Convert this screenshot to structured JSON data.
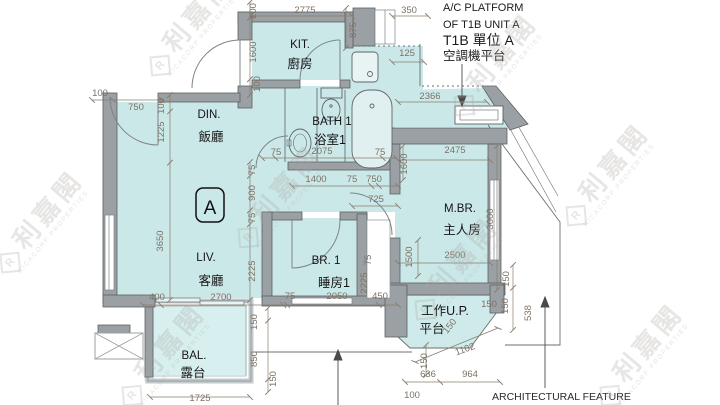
{
  "colors": {
    "room_fill": "#cbe8e9",
    "balcony_fill": "#d7efef",
    "wall": "#9aa0a3",
    "wall_edge": "#5c6164",
    "dim": "#7d7264",
    "label": "#141414",
    "watermark": "#a8a49f"
  },
  "unit_label": "A",
  "rooms": {
    "kitchen": {
      "en": "KIT.",
      "cn": "廚房"
    },
    "dining": {
      "en": "DIN.",
      "cn": "飯廳"
    },
    "bath": {
      "en": "BATH 1",
      "cn": "浴室1"
    },
    "living": {
      "en": "LIV.",
      "cn": "客廳"
    },
    "bedroom1": {
      "en": "BR. 1",
      "cn": "睡房1"
    },
    "master_bedroom": {
      "en": "M.BR.",
      "cn": "主人房"
    },
    "balcony": {
      "en": "BAL.",
      "cn": "露台"
    },
    "utility_platform": {
      "en": "工作U.P.",
      "cn": "平台"
    }
  },
  "notes": {
    "ac_line1": "A/C PLATFORM",
    "ac_line2": "OF T1B UNIT A",
    "ac_line3": "T1B 單位 A",
    "ac_line4": "空調機平台",
    "feature": "ARCHITECTURAL FEATURE"
  },
  "watermark": {
    "logo": "R",
    "cn": "利嘉閣",
    "en": "RICACORP PROPERTIES"
  },
  "dimensions": [
    [
      "2775",
      305,
      13,
      0
    ],
    [
      "100",
      256,
      11,
      -90
    ],
    [
      "1600",
      256,
      52,
      -90
    ],
    [
      "100",
      260,
      84,
      -90
    ],
    [
      "875",
      356,
      30,
      -90
    ],
    [
      "350",
      409,
      13,
      0
    ],
    [
      "125",
      407,
      56,
      0
    ],
    [
      "2366",
      430,
      99,
      0
    ],
    [
      "100",
      100,
      96,
      0
    ],
    [
      "750",
      136,
      110,
      0
    ],
    [
      "100",
      164,
      106,
      -90
    ],
    [
      "1225",
      164,
      132,
      -90
    ],
    [
      "3650",
      163,
      241,
      -90
    ],
    [
      "75",
      276,
      155,
      0
    ],
    [
      "2075",
      322,
      154,
      0
    ],
    [
      "75",
      380,
      155,
      0
    ],
    [
      "75",
      255,
      170,
      -90
    ],
    [
      "900",
      255,
      193,
      -90
    ],
    [
      "75",
      255,
      218,
      -90
    ],
    [
      "2225",
      255,
      271,
      -90
    ],
    [
      "1400",
      316,
      182,
      0
    ],
    [
      "75",
      352,
      182,
      0
    ],
    [
      "750",
      374,
      182,
      0
    ],
    [
      "725",
      376,
      202,
      0
    ],
    [
      "75",
      371,
      260,
      -90
    ],
    [
      "2225",
      367,
      283,
      -90
    ],
    [
      "1500",
      412,
      257,
      -90
    ],
    [
      "2475",
      455,
      153,
      0
    ],
    [
      "1600",
      407,
      164,
      -90
    ],
    [
      "3000",
      493,
      219,
      -90
    ],
    [
      "2500",
      455,
      258,
      0
    ],
    [
      "400",
      157,
      300,
      0
    ],
    [
      "2700",
      221,
      300,
      0
    ],
    [
      "75",
      290,
      299,
      0
    ],
    [
      "2050",
      337,
      299,
      0
    ],
    [
      "450",
      380,
      299,
      0
    ],
    [
      "150",
      257,
      322,
      -90
    ],
    [
      "850",
      257,
      359,
      -90
    ],
    [
      "150",
      276,
      379,
      -90
    ],
    [
      "1725",
      200,
      401,
      0
    ],
    [
      "150",
      509,
      279,
      -90
    ],
    [
      "150",
      508,
      306,
      -90
    ],
    [
      "538",
      531,
      313,
      -90
    ],
    [
      "150",
      489,
      307,
      0
    ],
    [
      "150",
      452,
      328,
      -52
    ],
    [
      "1102",
      466,
      352,
      -20
    ],
    [
      "150",
      427,
      361,
      -90
    ],
    [
      "636",
      428,
      377,
      0
    ],
    [
      "964",
      470,
      377,
      0
    ],
    [
      "100",
      412,
      398,
      0
    ]
  ]
}
